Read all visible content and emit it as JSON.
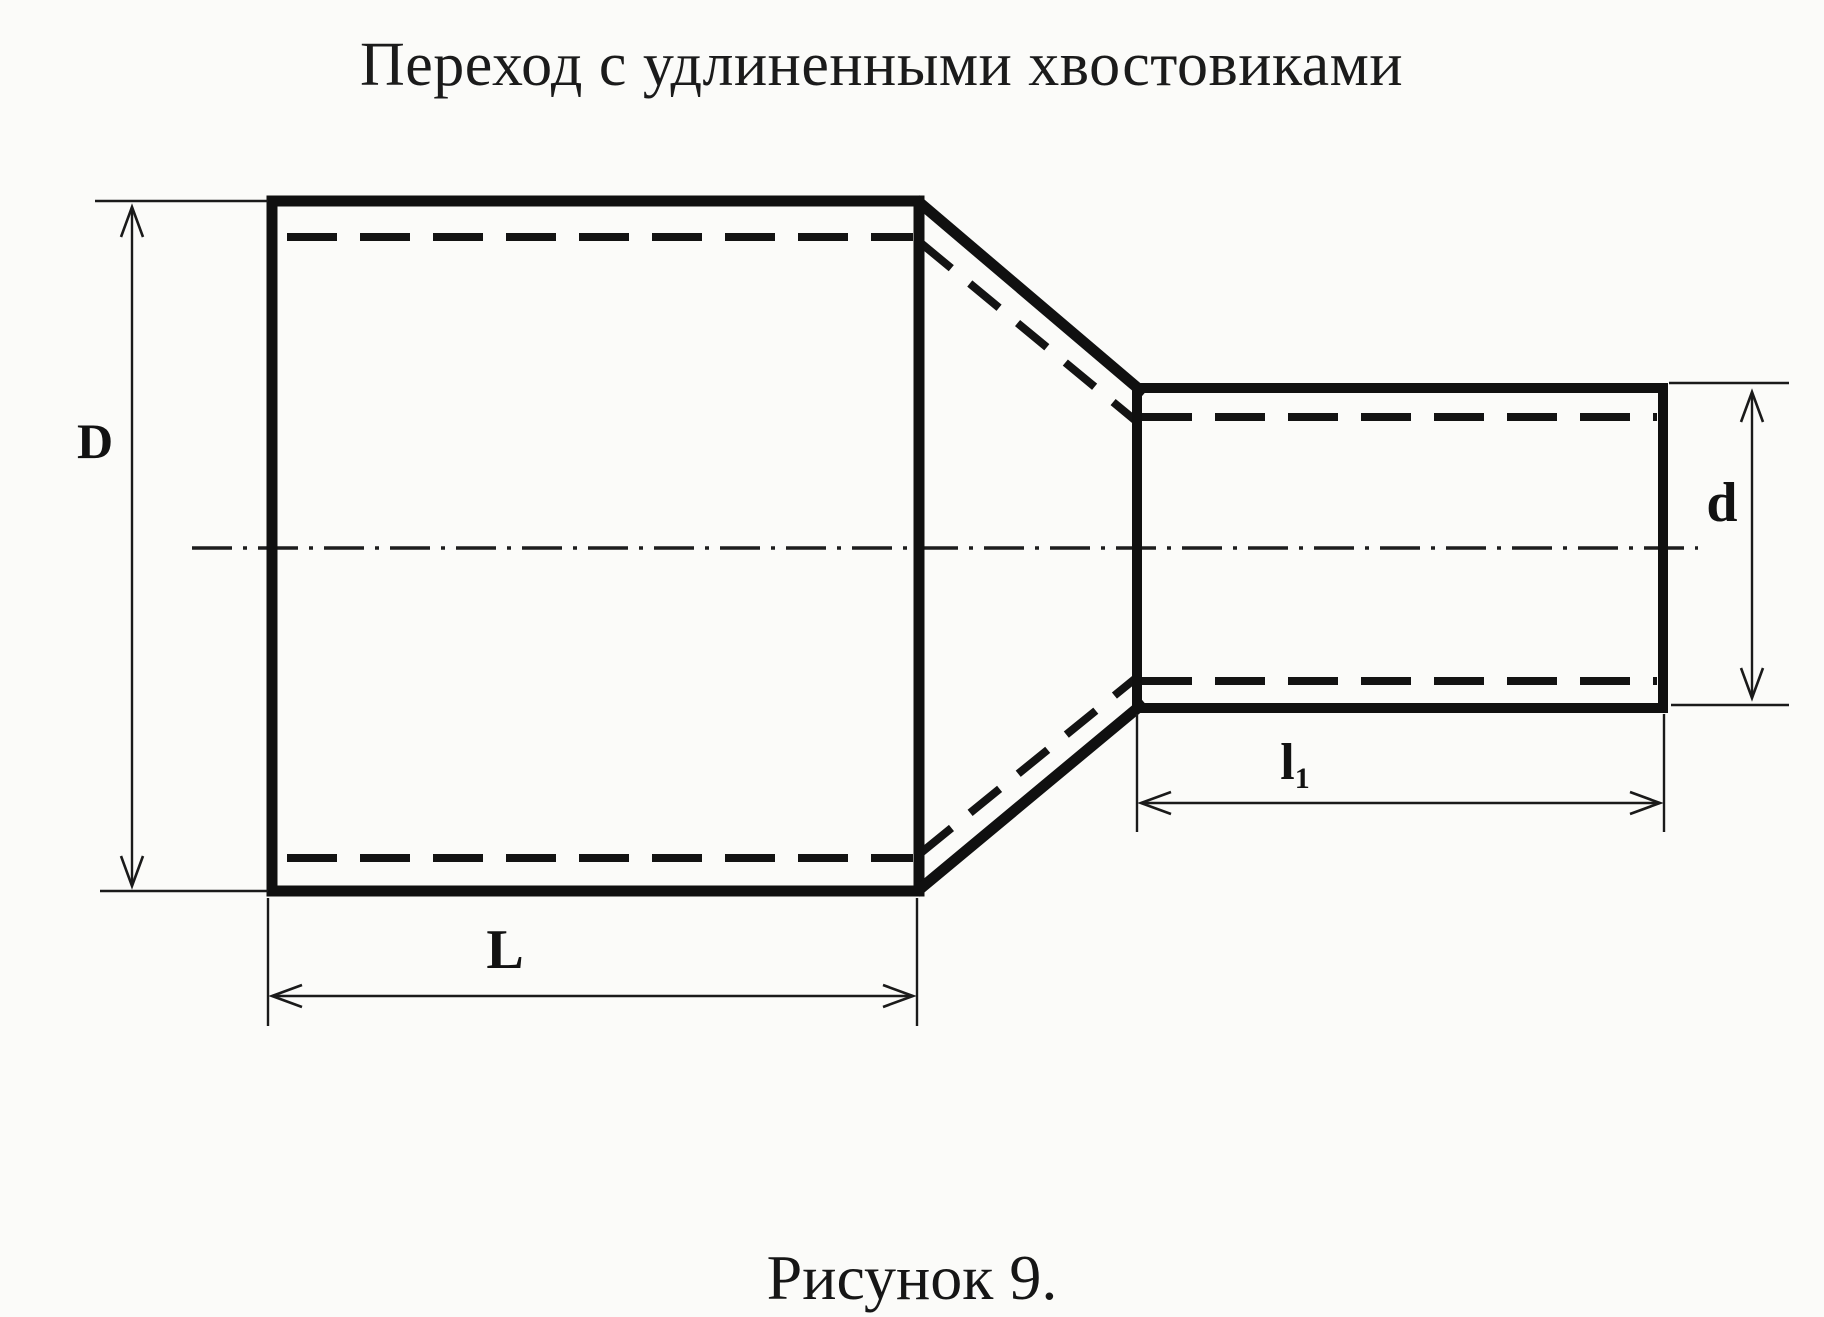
{
  "title": "Переход с удлиненными хвостовиками",
  "caption": "Рисунок 9.",
  "dimensions": {
    "large_diameter": "D",
    "large_length": "L",
    "small_diameter": "d",
    "small_length_base": "l",
    "small_length_sub": "1"
  },
  "colors": {
    "ink": "#101010",
    "paper": "#fbfbf9"
  }
}
